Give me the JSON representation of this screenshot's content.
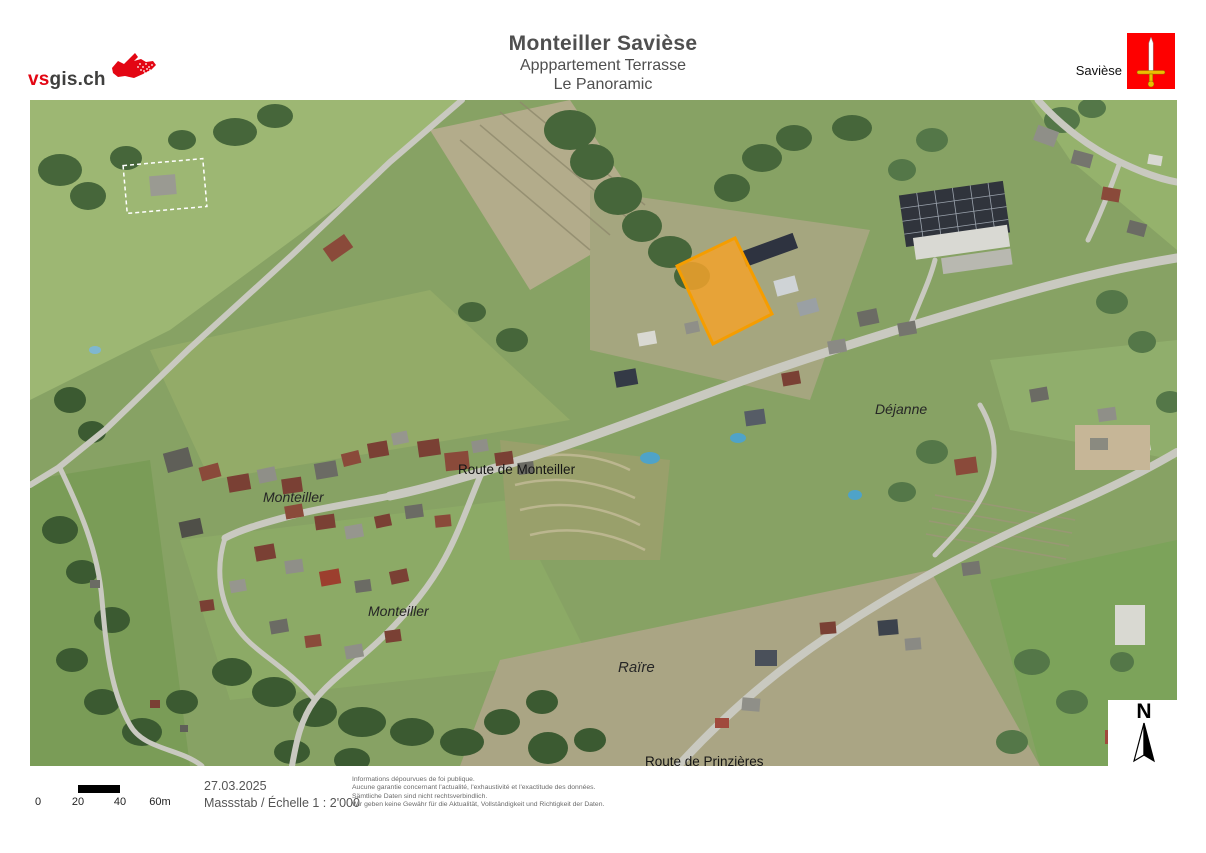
{
  "header": {
    "logo": {
      "text_red": "vs",
      "text_dark": "gis.ch"
    },
    "title": "Monteiller Savièse",
    "subtitle_line1": "Apppartement Terrasse",
    "subtitle_line2": "Le Panoramic",
    "municipality_label": "Savièse"
  },
  "map": {
    "labels": {
      "route_de_monteiller": "Route de Monteiller",
      "monteiller_upper": "Monteiller",
      "monteiller_lower": "Monteiller",
      "dejanne": "Déjanne",
      "raire": "Raïre",
      "route_de_prinzieres": "Route de Prinzières"
    },
    "north_label": "N",
    "highlight": {
      "fill": "#F2A22B",
      "stroke": "#F59D00"
    }
  },
  "footer": {
    "scalebar_ticks": [
      "0",
      "20",
      "40",
      "60m"
    ],
    "date": "27.03.2025",
    "scale_label": "Massstab / Échelle  1 : 2'000",
    "disclaimer_fr_1": "Informations dépourvues de foi publique.",
    "disclaimer_fr_2": "Aucune garantie concernant l'actualité, l'exhaustivité et l'exactitude des données.",
    "disclaimer_de_1": "Sämtliche Daten sind nicht rechtsverbindlich.",
    "disclaimer_de_2": "Wir geben keine Gewähr für die Aktualität, Vollständigkeit und Richtigkeit der Daten."
  }
}
